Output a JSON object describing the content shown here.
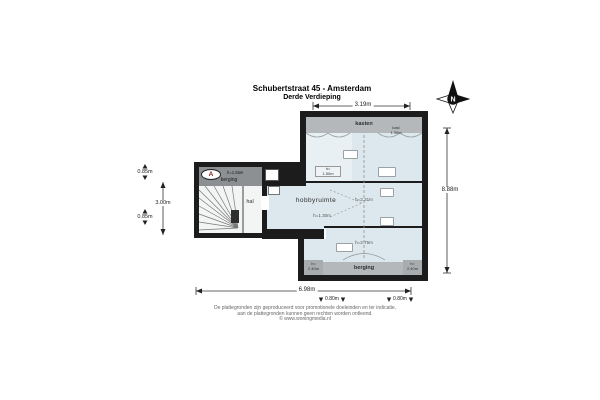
{
  "title": {
    "line1": "Schubertstraat 45 - Amsterdam",
    "line2": "Derde Verdieping"
  },
  "compass": {
    "label": "N"
  },
  "marker": {
    "label": "A"
  },
  "rooms": {
    "kasten": "kasten",
    "hobbyruimte": "hobbyruimte",
    "berging_attic": "berging",
    "berging_annex": "berging",
    "hal": "hal"
  },
  "height_labels": {
    "kast_top_line1": "kast",
    "kast_top_line2": "1.30m",
    "under_kasten_line1": "h=",
    "under_kasten_line2": "1.50m",
    "hobby_ridge": "h=2.31m",
    "hobby_low": "h=1.30m",
    "lower_ridge": "h=2.75m",
    "annex": "h=1.55m",
    "corner_left_line1": "h=",
    "corner_left_line2": "2.40m",
    "corner_right_line1": "h=",
    "corner_right_line2": "2.40m"
  },
  "dimensions": {
    "top": "3.19m",
    "bottom": "6.98m",
    "right": "8.88m",
    "left_top": "0.85m",
    "left_mid": "3.00m",
    "left_bottom": "0.85m",
    "strip_left": "0.80m",
    "strip_right": "0.80m"
  },
  "footer": {
    "line1": "De plattegronden zijn geproduceerd voor promotionele doeleinden en ter indicatie,",
    "line2": "aan de plattegronden kunnen geen rechten worden ontleend.",
    "line3": "© www.woningmedia.nl"
  },
  "colors": {
    "wall": "#1c1c1c",
    "room": "#dce8ee",
    "band": "#b4b8ba",
    "band_dark": "#a8acaf",
    "annex_band": "#8c9093",
    "marker_letter": "#8b1a1a"
  }
}
